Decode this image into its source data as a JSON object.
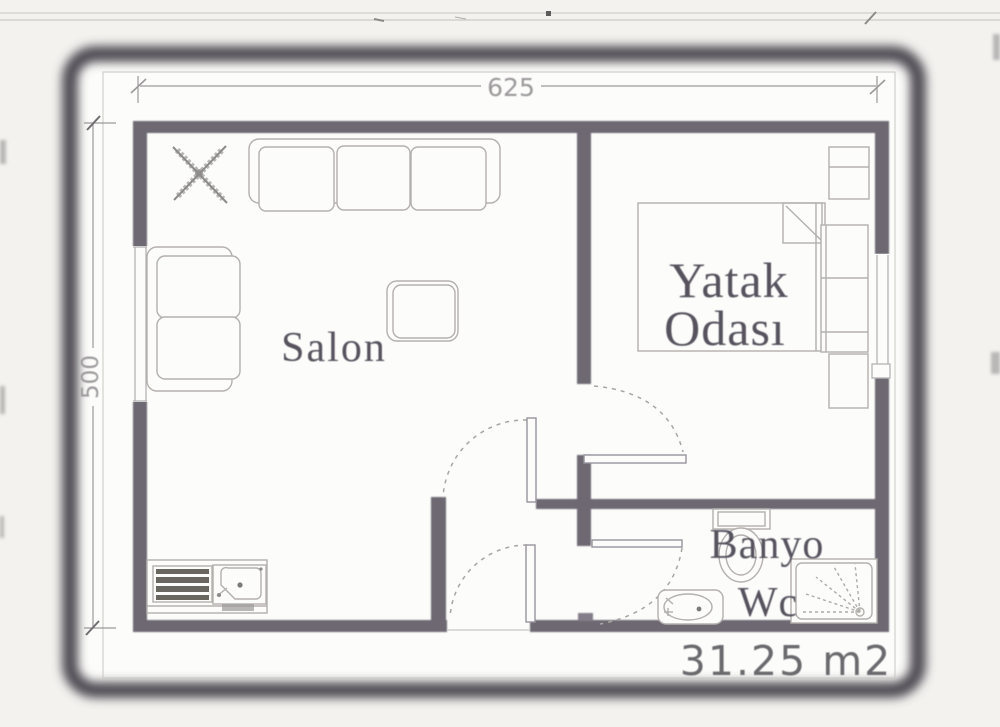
{
  "document_kind": "scanned floor plan",
  "colors": {
    "page_background": "#f3f2ef",
    "paper": "#fcfcfa",
    "scan_frame": "#4f4c52",
    "wall": "#6d6772",
    "furniture_line": "#b3b0ad",
    "label_text": "#57535e",
    "dimension": "#9b999b",
    "area_text": "#6b6a6e"
  },
  "labels": {
    "salon": "Salon",
    "bedroom_line1": "Yatak",
    "bedroom_line2": "Odası",
    "bath_line1": "Banyo",
    "bath_line2": "Wc",
    "area": "31.25 m2",
    "dim_width": "625",
    "dim_height": "500"
  },
  "rooms": [
    {
      "name": "Salon"
    },
    {
      "name": "Yatak Odası"
    },
    {
      "name": "Banyo Wc"
    }
  ],
  "dimensions": {
    "width": "625",
    "height": "500",
    "area": "31.25 m2"
  },
  "furniture_icons": [
    "plant-icon",
    "sofa-icon",
    "loveseat-icon",
    "coffee-table-icon",
    "kitchen-counter-icon",
    "stove-icon",
    "kitchen-sink-icon",
    "double-bed-icon",
    "wardrobe-icon",
    "nightstand-icon",
    "cabinet-icon",
    "toilet-icon",
    "shower-icon",
    "washbasin-icon",
    "door-swing-icon",
    "window-icon"
  ]
}
